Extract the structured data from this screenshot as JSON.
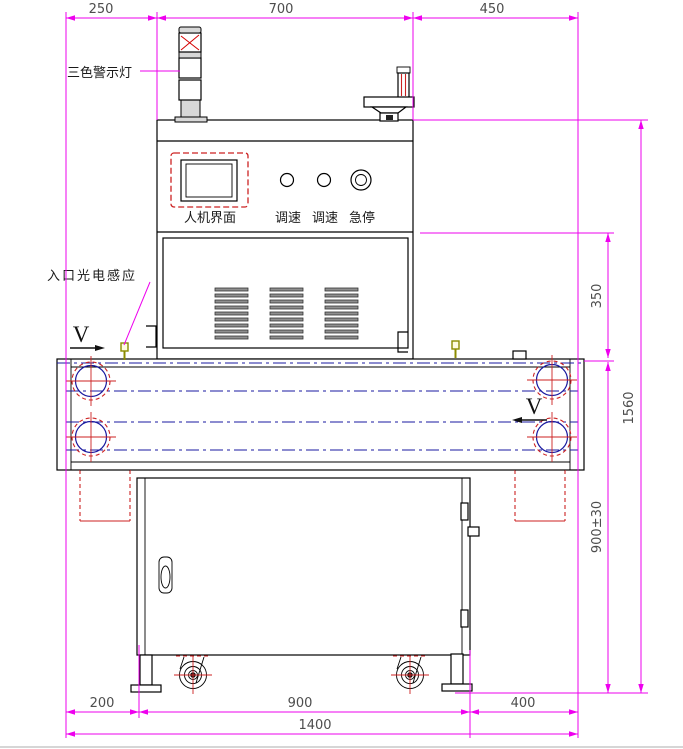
{
  "labels": {
    "tower_light": "三色警示灯",
    "entry_sensor": "入口光电感应",
    "hmi_screen": "人机界面",
    "speed_knob_1": "调速",
    "speed_knob_2": "调速",
    "emergency_stop": "急停",
    "direction_in": "V",
    "direction_out": "V"
  },
  "dimensions": {
    "top_left": "250",
    "top_center": "700",
    "top_right": "450",
    "tunnel_height": "350",
    "total_height": "1560",
    "belt_height": "900±30",
    "bottom_left_offset": "200",
    "cabinet_width": "900",
    "bottom_right_offset": "400",
    "total_width": "1400"
  },
  "colors": {
    "dimension_line": "#ee00ee",
    "dimension_text": "#4d4d4d",
    "outline": "#000000",
    "centerline": "#1a1aa0",
    "hidden_line": "#cc2222",
    "light_red": "#ff2020",
    "light_yellow": "#ffff00",
    "light_green": "#2ee02e",
    "metal_gray": "#d8d8d8",
    "sensor": "#8b8b00"
  }
}
